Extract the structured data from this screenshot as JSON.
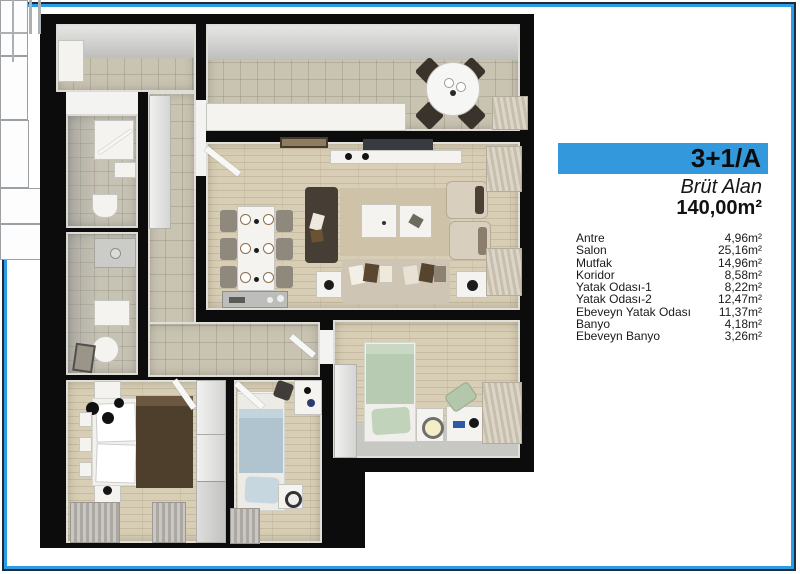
{
  "panel": {
    "banner": {
      "label": "3+1/A"
    },
    "gross_area": {
      "label": "Brüt Alan",
      "value": "140,00m²"
    },
    "rooms": [
      {
        "name": "Antre",
        "area": "4,96m²"
      },
      {
        "name": "Salon",
        "area": "25,16m²"
      },
      {
        "name": "Mutfak",
        "area": "14,96m²"
      },
      {
        "name": "Koridor",
        "area": "8,58m²"
      },
      {
        "name": "Yatak Odası-1",
        "area": "8,22m²"
      },
      {
        "name": "Yatak Odası-2",
        "area": "12,47m²"
      },
      {
        "name": "Ebeveyn Yatak Odası",
        "area": "11,37m²"
      },
      {
        "name": "Banyo",
        "area": "4,18m²"
      },
      {
        "name": "Ebeveyn Banyo",
        "area": "3,26m²"
      }
    ]
  },
  "colors": {
    "banner_blue": "#3399dc",
    "frame_blue": "#2e9ce4",
    "frame_navy": "#1c2b40"
  }
}
